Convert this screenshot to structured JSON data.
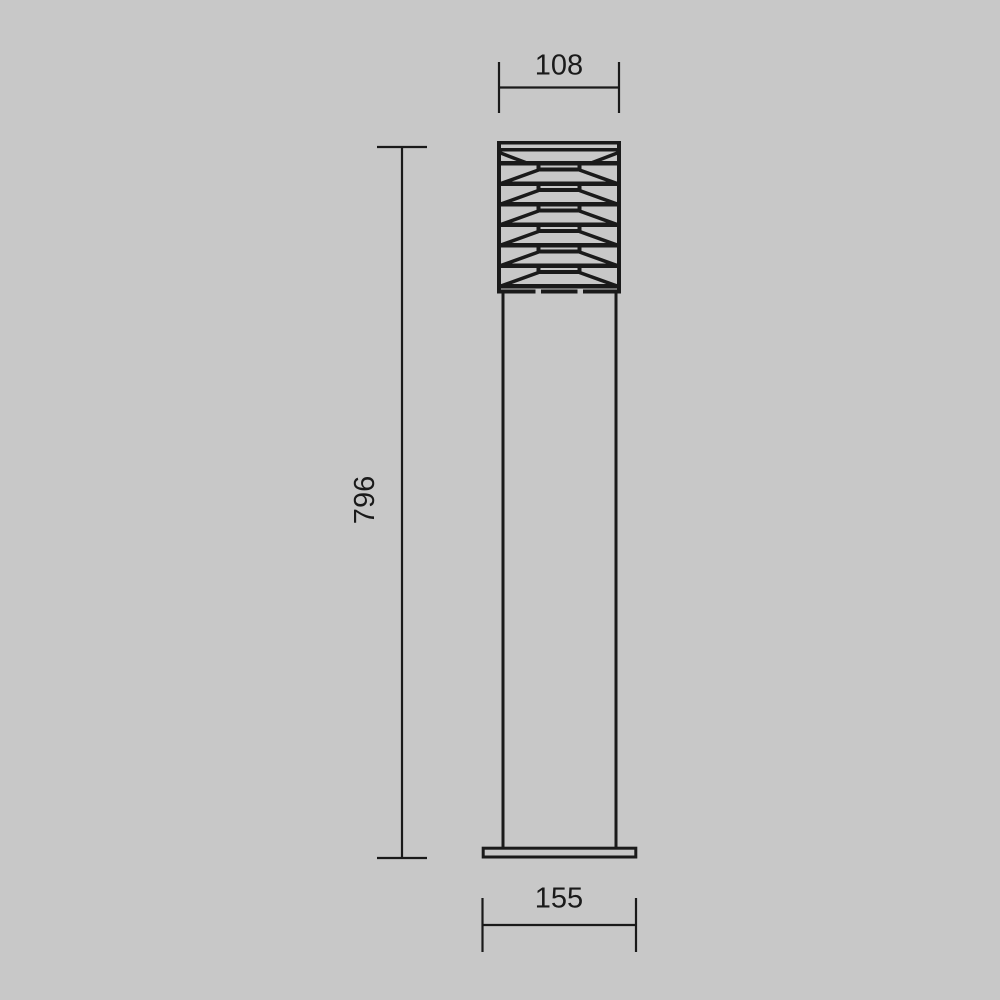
{
  "colors": {
    "background": "#c8c8c8",
    "line": "#1a1a1a"
  },
  "drawing": {
    "dimensions": {
      "head_width": "108",
      "overall_height": "796",
      "base_width": "155"
    }
  }
}
